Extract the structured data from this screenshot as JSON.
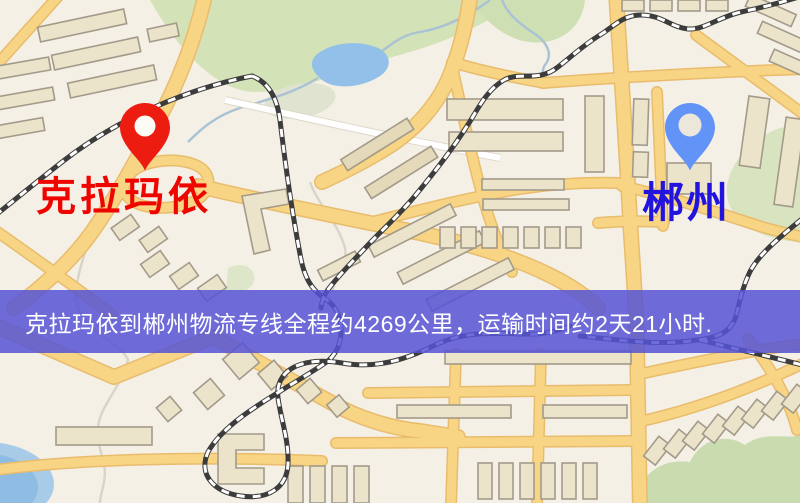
{
  "map": {
    "kind": "stylized-road-map",
    "colors": {
      "background": "#f4f0e6",
      "park": "#d4e2b8",
      "water": "#92c0e8",
      "road_fill": "#f7d584",
      "road_casing": "#e9bc6d",
      "building_fill": "#ece3cb",
      "building_outline": "#a49a8a",
      "railway": "#3c3c3c"
    }
  },
  "markers": {
    "origin": {
      "label": "克拉玛依",
      "pin_color": "#ed1c10",
      "pin_hole_color": "#fdfbf5",
      "label_color": "#ee0500"
    },
    "destination": {
      "label": "郴州",
      "pin_color": "#6294f8",
      "pin_hole_color": "#ece7da",
      "label_color": "#2213dd"
    }
  },
  "banner": {
    "text": "克拉玛依到郴州物流专线全程约4269公里，运输时间约2天21小时.",
    "background_color": "#5654d6",
    "text_color": "#ffffff"
  }
}
